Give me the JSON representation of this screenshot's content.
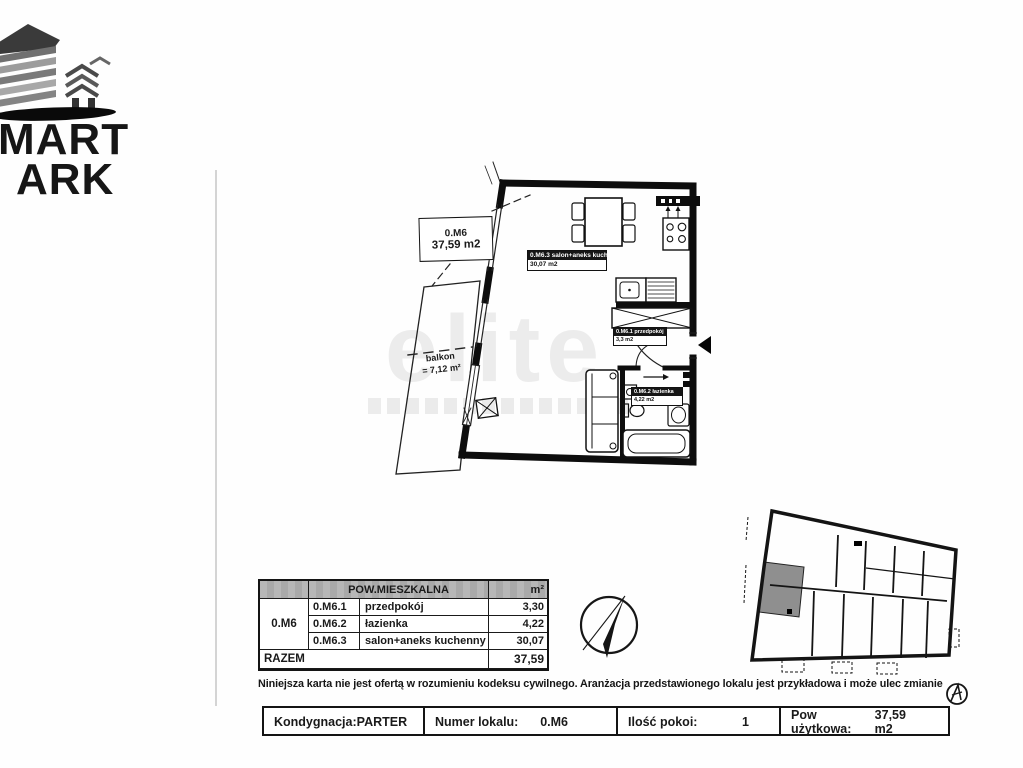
{
  "logo": {
    "line1": "MART",
    "line2": "ARK"
  },
  "watermark": {
    "text": "elite"
  },
  "floor_plan": {
    "unit_box": {
      "code": "0.M6",
      "area": "37,59 m2"
    },
    "balcony": {
      "name": "balkon",
      "area": "= 7,12 m²"
    },
    "rooms": [
      {
        "title": "0.M6.3 salon+aneks kuch.",
        "area": "30,07 m2"
      },
      {
        "title": "0.M6.1 przedpokój",
        "area": "3,3 m2"
      },
      {
        "title": "0.M6.2 łazienka",
        "area": "4,22 m2"
      }
    ]
  },
  "area_table": {
    "header_title": "POW.MIESZKALNA",
    "header_unit": "m²",
    "group_code": "0.M6",
    "rows": [
      {
        "code": "0.M6.1",
        "name": "przedpokój",
        "area": "3,30"
      },
      {
        "code": "0.M6.2",
        "name": "łazienka",
        "area": "4,22"
      },
      {
        "code": "0.M6.3",
        "name": "salon+aneks kuchenny",
        "area": "30,07"
      }
    ],
    "total_label": "RAZEM",
    "total_value": "37,59"
  },
  "disclaimer": "Niniejsza karta nie jest ofertą w rozumieniu kodeksu cywilnego. Aranżacja przedstawionego lokalu jest przykładowa i może ulec zmianie",
  "info_bar": {
    "cells": [
      {
        "label": "Kondygnacja:",
        "value": "PARTER"
      },
      {
        "label": "Numer lokalu:",
        "value": "0.M6"
      },
      {
        "label": "Ilość pokoi:",
        "value": "1"
      },
      {
        "label": "Pow użytkowa:",
        "value": "37,59 m2"
      }
    ]
  },
  "colors": {
    "ink": "#1a1a1a",
    "wall": "#0d0d0d",
    "table_header_gray": "#b4b4b4",
    "unit_highlight_gray": "#8f8f8f",
    "watermark_gray": "#9a9a9a"
  }
}
